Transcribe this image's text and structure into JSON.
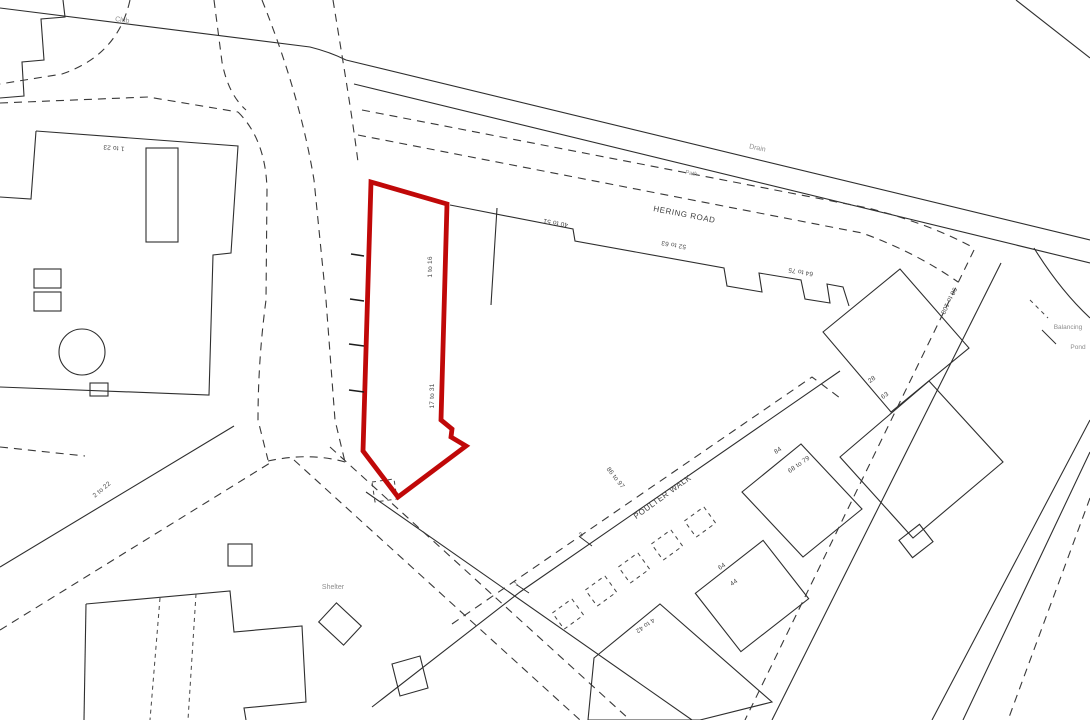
{
  "map": {
    "background": "#ffffff",
    "line_color": "#2e2e2e",
    "boundary_color": "#c00808",
    "faint_text_color": "#8d8d8d",
    "streets": {
      "hering_road": "HERING ROAD",
      "poulter_walk": "POULTER WALK"
    },
    "features": {
      "shelter": "Shelter",
      "club": "Club",
      "drain": "Drain",
      "path": "Path",
      "balancing": "Balancing",
      "pond": "Pond"
    },
    "number_ranges": {
      "r1_23": "1 to 23",
      "r2_22": "2 to 22",
      "r40_51": "40 to 51",
      "r52_63": "52 to 63",
      "r64_75": "64 to 75",
      "r1_16": "1 to 16",
      "r17_31": "17 to 31",
      "r86_97": "86 to 97",
      "r4_42": "4 to 42",
      "r68_79": "68 to 79",
      "r98_108": "98 to 108"
    },
    "house_numbers": {
      "n84": "84",
      "n64": "64",
      "n44": "44",
      "n28": "28",
      "n63": "63",
      "n3": "3",
      "n1": "1"
    }
  }
}
